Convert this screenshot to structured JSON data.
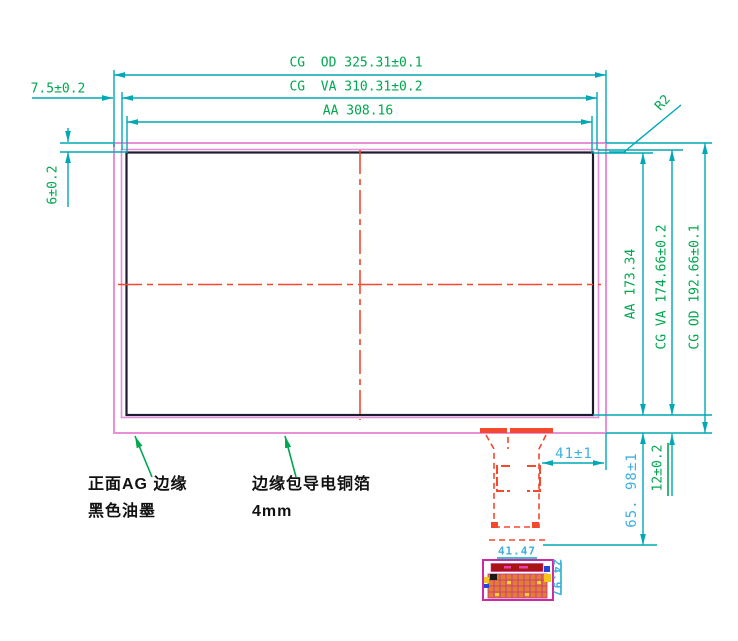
{
  "colors": {
    "dimension_line": "#00a8b6",
    "dimension_text_green": "#00a651",
    "dimension_text_blue": "#3fafdf",
    "outline_pink": "#e98fd7",
    "detail_magenta": "#cb2ba1",
    "tail_red": "#f2492f",
    "aa_outline_black": "#1c1c30",
    "pad_orange": "#e0802e"
  },
  "dimensions": {
    "cg_od_width": "CG  OD 325.31±0.1",
    "cg_va_width": "CG  VA 310.31±0.2",
    "aa_width": "AA 308.16",
    "left_margin": "7.5±0.2",
    "top_margin": "6±0.2",
    "corner_radius": "R2",
    "aa_height": "AA 173.34",
    "cg_va_height": "CG VA 174.66±0.2",
    "cg_od_height": "CG OD 192.66±0.1",
    "tail_offset": "41±1",
    "tail_length": "65. 98±1",
    "bottom_margin": "12±0.2",
    "connector_width": "41.47",
    "connector_height": "24.97"
  },
  "annotations": {
    "front_ink_line1": "正面AG 边缘",
    "front_ink_line2": "黑色油墨",
    "copper_foil_line1": "边缘包导电铜箔",
    "copper_foil_line2": "4mm"
  }
}
